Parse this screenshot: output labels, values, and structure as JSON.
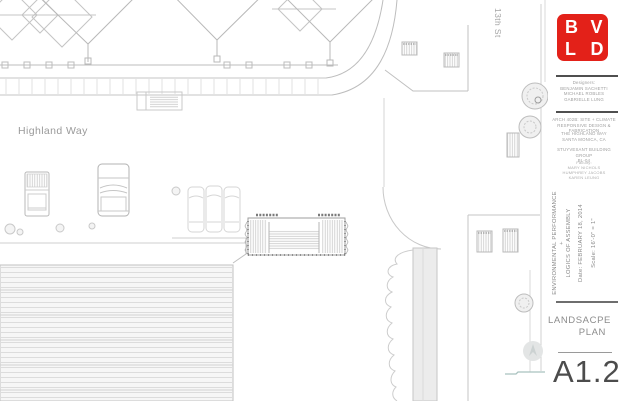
{
  "plan": {
    "street_h": "Highland Way",
    "street_v": "13th St"
  },
  "title_block": {
    "logo": {
      "letters": [
        "B",
        "V",
        "L",
        "D"
      ],
      "color": "#e32119"
    },
    "credits": [
      "Designers:",
      "BENJAMIN SACHETTI",
      "MICHAEL ROBLES",
      "GABRIELLE LUNG"
    ],
    "course": [
      "ARCH 402B: SITE + CLIMATE",
      "RESPONSIVE DESIGN & FABRICATION"
    ],
    "location": [
      "THE HIGHLAND WAY",
      "SANTA MONICA, CA"
    ],
    "firm": [
      "STUYVESANT BUILDING GROUP",
      "BL-04"
    ],
    "faculty": [
      "Faculty:",
      "MARY NICHOLS",
      "HUMPHREY JACOBS",
      "KAREN LEUNG"
    ],
    "project_title": [
      "ENVIRONMENTAL PERFORMANCE",
      "+",
      "LOGICS OF ASSEMBLY"
    ],
    "date": "Date: FEBRUARY 18, 2014",
    "scale": "Scale: 16'-0\" = 1\"",
    "sheet_name": [
      "LANDSACPE",
      "PLAN"
    ],
    "sheet_number": "A1.2"
  }
}
